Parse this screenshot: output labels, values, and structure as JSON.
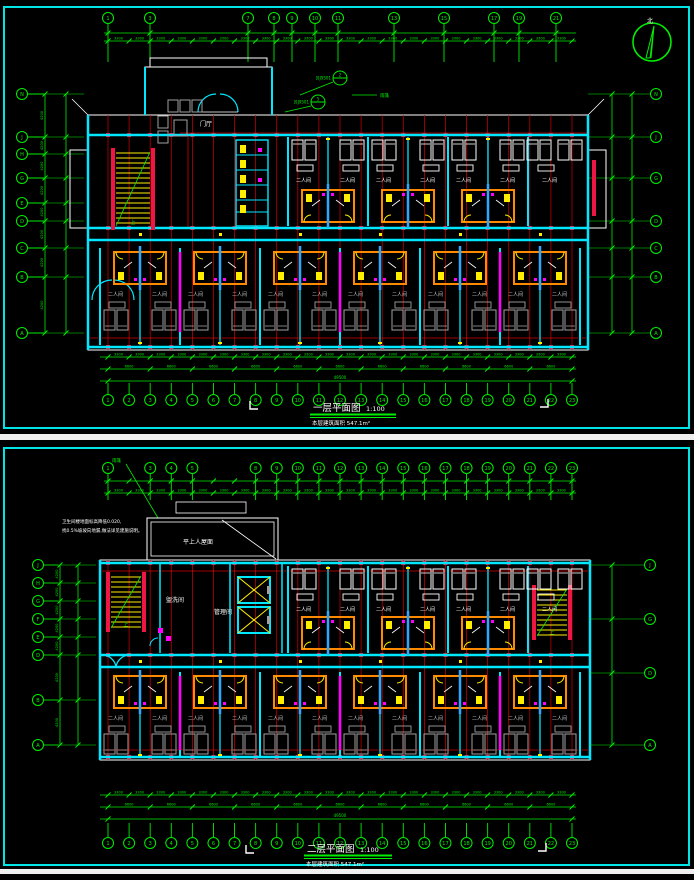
{
  "colors": {
    "bg": "#000000",
    "frame_cyan": "#00e5e5",
    "wall_cyan": "#00e8ff",
    "riser_blue": "#2ea8ff",
    "axis_green": "#00ee00",
    "grid_red": "#d40000",
    "column_red": "#ee1743",
    "pod_orange": "#ff8a00",
    "fixture_yellow": "#ffee00",
    "pipe_magenta": "#ff00ff",
    "line_white": "#ffffff",
    "furniture_gray": "#a0a0a0",
    "seam_white": "#efefef"
  },
  "north": {
    "label": "北"
  },
  "plans": [
    {
      "name": "first-floor-plan",
      "title": "一层平面图",
      "scale": "1:100",
      "area_note": "本层建筑面积 547.1m²",
      "axis_numbers": [
        "1",
        "2",
        "3",
        "4",
        "5",
        "6",
        "7",
        "8",
        "9",
        "10",
        "11",
        "12",
        "13",
        "14",
        "15",
        "16",
        "17",
        "18",
        "19",
        "20",
        "21",
        "22",
        "23"
      ],
      "axis_top_labels": [
        "1",
        "3",
        "7",
        "8",
        "9",
        "10",
        "11",
        "13",
        "15",
        "17",
        "19",
        "21"
      ],
      "axis_left": [
        "N",
        "J",
        "H",
        "G",
        "E",
        "D",
        "C",
        "B",
        "A"
      ],
      "axis_right": [
        "N",
        "J",
        "G",
        "D",
        "C",
        "B",
        "A"
      ],
      "rooms": {
        "double_room": "二人间",
        "lobby": "门厅",
        "stair_up": "上"
      },
      "detail_refs": [
        {
          "code": "苏J9501",
          "num": "2"
        },
        {
          "code": "苏J9501",
          "num": "5"
        }
      ],
      "canopy": "雨篷",
      "dims": {
        "bay": "3300",
        "group": "6600",
        "total": "49500",
        "side": "4200"
      }
    },
    {
      "name": "second-floor-plan",
      "title": "二层平面图",
      "scale": "1:100",
      "area_note": "本层建筑面积 547.1m²",
      "axis_numbers": [
        "1",
        "2",
        "3",
        "4",
        "5",
        "6",
        "7",
        "8",
        "9",
        "10",
        "11",
        "12",
        "13",
        "14",
        "15",
        "16",
        "17",
        "18",
        "19",
        "20",
        "21",
        "22",
        "23"
      ],
      "axis_top_labels": [
        "1",
        "3",
        "4",
        "5",
        "8",
        "9",
        "10",
        "11",
        "12",
        "13",
        "14",
        "15",
        "16",
        "17",
        "18",
        "19",
        "20",
        "21",
        "22",
        "23"
      ],
      "axis_left": [
        "J",
        "H",
        "G",
        "F",
        "E",
        "D",
        "B",
        "A"
      ],
      "axis_right": [
        "J",
        "G",
        "D",
        "A"
      ],
      "rooms": {
        "double_room": "二人间",
        "laundry": "盥洗间",
        "office": "管理间",
        "stair_up": "上",
        "roof": "平上人屋面"
      },
      "notes": [
        "卫生间楼地面标高降低0.020,",
        "找0.5%坡坡向地漏,做法详见建施说明。"
      ],
      "canopy": "雨篷",
      "dims": {
        "bay": "3300",
        "group": "6600",
        "total": "49500",
        "side": "4200"
      }
    }
  ]
}
